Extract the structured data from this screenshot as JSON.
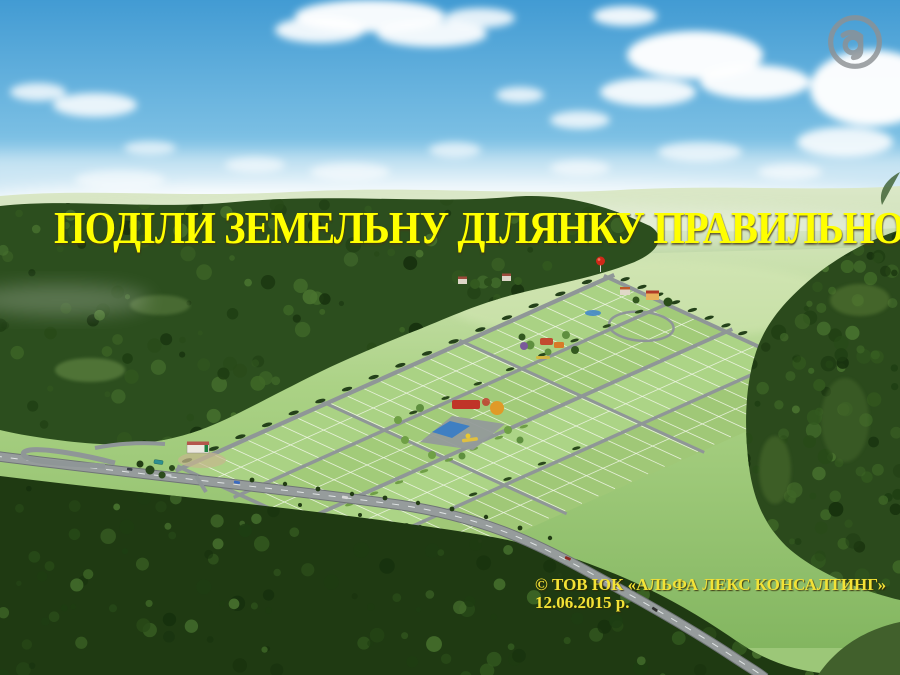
{
  "slide": {
    "title": "ПОДІЛИ ЗЕМЕЛЬНУ ДІЛЯНКУ ПРАВИЛЬНО!",
    "copyright": {
      "line1": "© ТОВ ЮК «АЛЬФА ЛЕКС КОНСАЛТИНГ»",
      "line2": "12.06.2015 р."
    },
    "logo_letter": "a"
  },
  "colors": {
    "title_text": "#ffff00",
    "copyright_text": "#f3e236",
    "logo_gray": "#8d9194",
    "sky_top": "#429bd3",
    "sky_horizon": "#eff5ee",
    "field_green": "#a8d080",
    "forest_dark": "#24421a",
    "road_gray": "#8f9697",
    "plot_line_white": "#f4f8ec",
    "balloon_red": "#d02818"
  }
}
